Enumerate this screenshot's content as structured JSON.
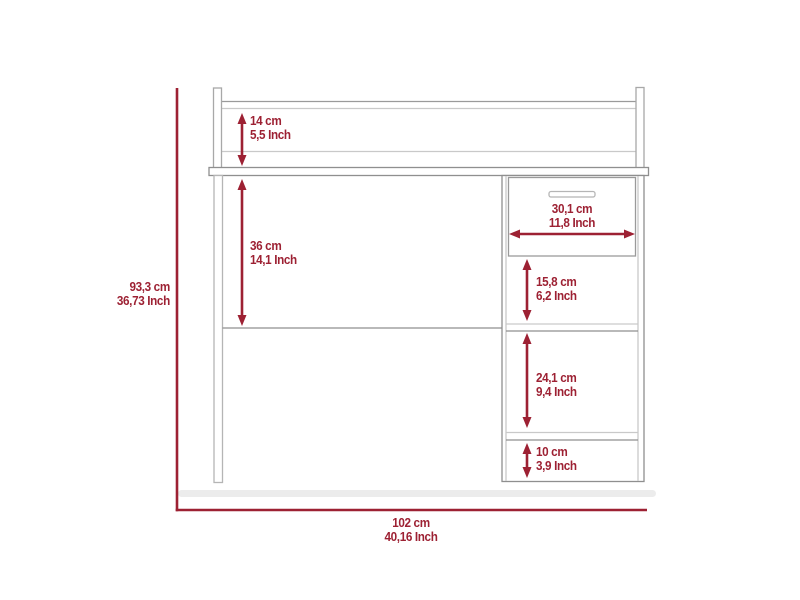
{
  "diagram": {
    "title": "desk-dimension-drawing",
    "product": "computer desk with hutch shelf, left leg and right cabinet with drawer",
    "units": [
      "cm",
      "Inch"
    ],
    "colors": {
      "dimension_accent": "#9d2133",
      "furniture_line": "#8f8f8f",
      "furniture_line_light": "#c9c9c9",
      "shadow": "#ececec",
      "background": "#ffffff"
    },
    "dimensions": [
      {
        "id": "hutch-height",
        "cm": "14 cm",
        "inch": "5,5 Inch"
      },
      {
        "id": "desk-clearance",
        "cm": "36 cm",
        "inch": "14,1 Inch"
      },
      {
        "id": "overall-height",
        "cm": "93,3 cm",
        "inch": "36,73 Inch"
      },
      {
        "id": "drawer-width",
        "cm": "30,1 cm",
        "inch": "11,8 Inch"
      },
      {
        "id": "upper-cubby-height",
        "cm": "15,8 cm",
        "inch": "6,2 Inch"
      },
      {
        "id": "middle-cubby-height",
        "cm": "24,1 cm",
        "inch": "9,4 Inch"
      },
      {
        "id": "bottom-cubby-height",
        "cm": "10 cm",
        "inch": "3,9 Inch"
      }
    ],
    "overall_width": {
      "cm": "102 cm",
      "inch": "40,16 Inch"
    }
  }
}
